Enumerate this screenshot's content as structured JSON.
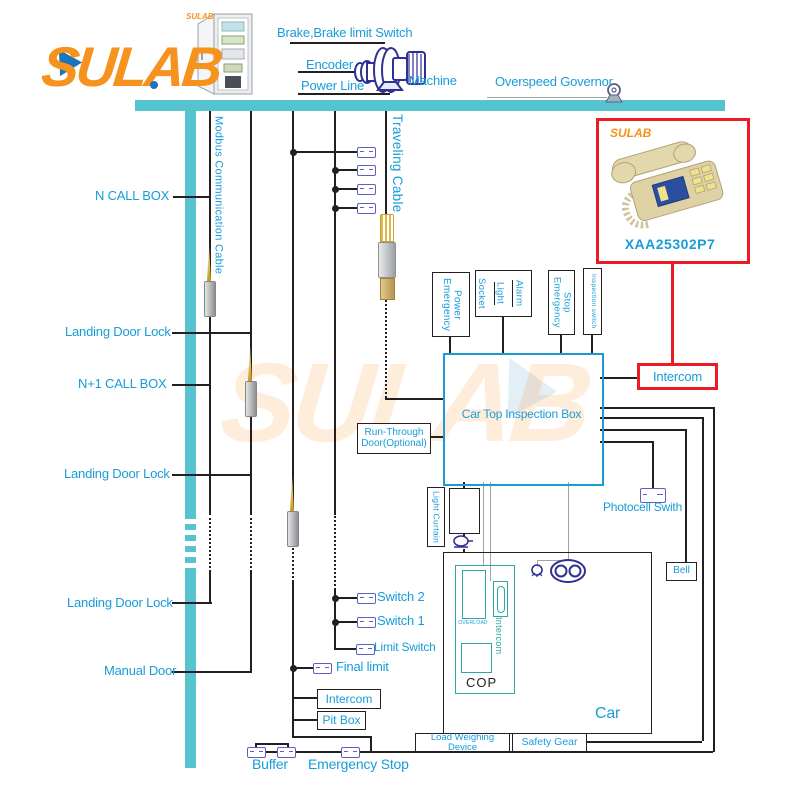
{
  "brand": {
    "name": "SULAB",
    "cabinet_brand": "SULAB",
    "watermark": "SULAB"
  },
  "machine_room": {
    "brake": "Brake,Brake limit Switch",
    "encoder": "Encoder",
    "power_line": "Power Line",
    "machine": "Machine",
    "overspeed_governor": "Overspeed Governor"
  },
  "shaft": {
    "modbus_cable": "Modbus Communication Cable",
    "traveling_cable": "Traveling Cable",
    "n_call_box": "N CALL BOX",
    "landing_door_lock_1": "Landing Door Lock",
    "n_plus_1_call_box": "N+1 CALL BOX",
    "landing_door_lock_2": "Landing Door Lock",
    "landing_door_lock_3": "Landing Door Lock",
    "manual_door": "Manual Door"
  },
  "product": {
    "brand": "SULAB",
    "model": "XAA25302P7",
    "intercom": "Intercom"
  },
  "car_top": {
    "title": "Car Top Inspection Box",
    "run_through_door": "Run-Through Door(Optional)",
    "emergency_power": "Emergency\nPower",
    "socket": "Socket",
    "light": "Light",
    "alarm": "Alarm",
    "emergency_stop": "Emergency\nStop",
    "inspection_switch": "Inspection switch"
  },
  "car": {
    "label": "Car",
    "cop": "COP",
    "overload": "OVERLOAD",
    "intercom": "Intercom",
    "light_curtain": "Light Curtain",
    "photocell_switch": "Photocell Swith",
    "bell": "Bell",
    "load_weighing_device": "Load Weighing Device",
    "safety_gear": "Safety Gear"
  },
  "pit": {
    "switch_2": "Switch 2",
    "switch_1": "Switch 1",
    "limit_switch": "Limit Switch",
    "final_limit": "Final limit",
    "intercom": "Intercom",
    "pit_box": "Pit Box",
    "buffer": "Buffer",
    "emergency_stop": "Emergency Stop"
  },
  "colors": {
    "teal_rail": "#55c4cf",
    "label_blue": "#189cd8",
    "wire_black": "#231f20",
    "accent_red": "#ec1c24",
    "brand_orange": "#f6921e",
    "cop_teal": "#2fa8a4",
    "connector_violet": "#5f5fc0"
  }
}
